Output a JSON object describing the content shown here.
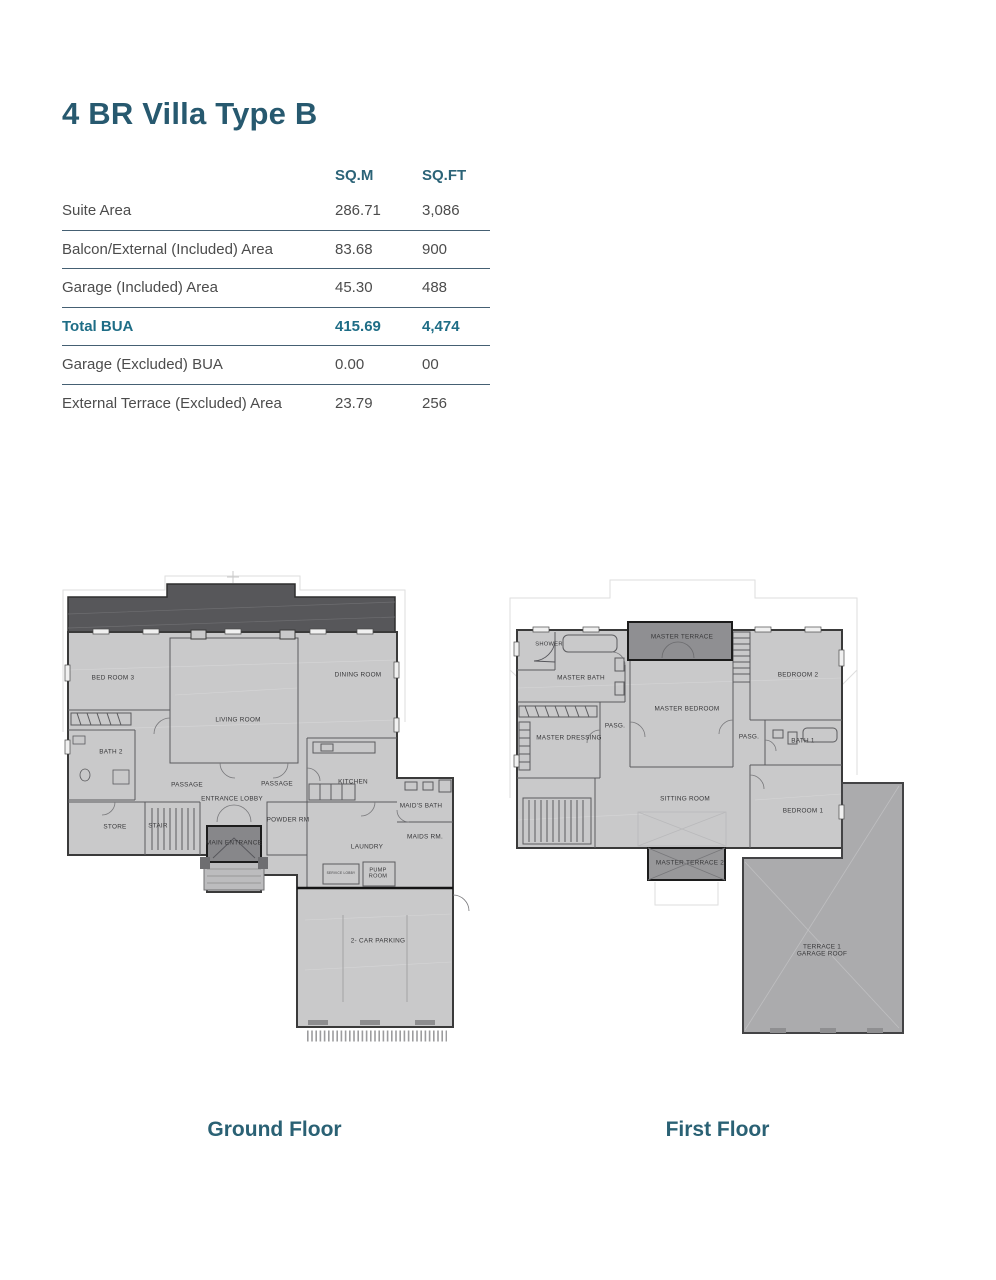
{
  "title": "4 BR Villa Type B",
  "table": {
    "col_headers": [
      "SQ.M",
      "SQ.FT"
    ],
    "rows": [
      {
        "label": "Suite Area",
        "sqm": "286.71",
        "sqft": "3,086",
        "emphasis": false
      },
      {
        "label": "Balcon/External (Included) Area",
        "sqm": "83.68",
        "sqft": "900",
        "emphasis": false
      },
      {
        "label": "Garage (Included) Area",
        "sqm": "45.30",
        "sqft": "488",
        "emphasis": false
      },
      {
        "label": "Total BUA",
        "sqm": "415.69",
        "sqft": "4,474",
        "emphasis": true
      },
      {
        "label": "Garage (Excluded) BUA",
        "sqm": "0.00",
        "sqft": "00",
        "emphasis": false
      },
      {
        "label": "External Terrace (Excluded) Area",
        "sqm": "23.79",
        "sqft": "256",
        "emphasis": false
      }
    ]
  },
  "plans": [
    {
      "caption": "Ground Floor",
      "rooms": [
        {
          "label": "BED ROOM 3",
          "x": 58,
          "y": 108
        },
        {
          "label": "DINING ROOM",
          "x": 303,
          "y": 105
        },
        {
          "label": "LIVING ROOM",
          "x": 183,
          "y": 150
        },
        {
          "label": "BATH 2",
          "x": 56,
          "y": 182
        },
        {
          "label": "PASSAGE",
          "x": 132,
          "y": 215
        },
        {
          "label": "PASSAGE",
          "x": 222,
          "y": 214
        },
        {
          "label": "ENTRANCE LOBBY",
          "x": 177,
          "y": 229
        },
        {
          "label": "KITCHEN",
          "x": 298,
          "y": 212
        },
        {
          "label": "STORE",
          "x": 60,
          "y": 257
        },
        {
          "label": "STAIR",
          "x": 103,
          "y": 256
        },
        {
          "label": "POWDER RM",
          "x": 233,
          "y": 250
        },
        {
          "label": "MAIN ENTRANCE",
          "x": 179,
          "y": 273
        },
        {
          "label": "LAUNDRY",
          "x": 312,
          "y": 277
        },
        {
          "label": "MAID'S BATH",
          "x": 366,
          "y": 236
        },
        {
          "label": "MAIDS RM.",
          "x": 370,
          "y": 267
        },
        {
          "label": "SERVICE LOBBY",
          "x": 286,
          "y": 304,
          "size": 3.2
        },
        {
          "label": "PUMP\nROOM",
          "x": 323,
          "y": 304,
          "size": 5.6
        },
        {
          "label": "2- CAR PARKING",
          "x": 323,
          "y": 371
        }
      ]
    },
    {
      "caption": "First Floor",
      "rooms": [
        {
          "label": "SHOWER",
          "x": 44,
          "y": 75,
          "size": 5.8
        },
        {
          "label": "MASTER TERRACE",
          "x": 177,
          "y": 67
        },
        {
          "label": "BEDROOM 2",
          "x": 293,
          "y": 105
        },
        {
          "label": "MASTER BATH",
          "x": 76,
          "y": 108
        },
        {
          "label": "MASTER BEDROOM",
          "x": 182,
          "y": 139
        },
        {
          "label": "PASG.",
          "x": 110,
          "y": 156
        },
        {
          "label": "MASTER DRESSING",
          "x": 64,
          "y": 168
        },
        {
          "label": "PASG.",
          "x": 244,
          "y": 167
        },
        {
          "label": "BATH 1",
          "x": 298,
          "y": 171
        },
        {
          "label": "SITTING ROOM",
          "x": 180,
          "y": 229
        },
        {
          "label": "BEDROOM 1",
          "x": 298,
          "y": 241
        },
        {
          "label": "MASTER TERRACE 2",
          "x": 185,
          "y": 293
        },
        {
          "label": "TERRACE 1\nGARAGE ROOF",
          "x": 317,
          "y": 381
        }
      ]
    }
  ],
  "colors": {
    "accent": "#2B6377",
    "emphasis": "#1E6D86",
    "body_text": "#4C4C4C",
    "rule_line": "#456073",
    "plan_fill": "#C9C9CA",
    "roof_fill": "#57575A",
    "porch_fill": "#87878A",
    "terrace_fill": "#8F8F92",
    "garage_roof_fill": "#ABABAD"
  }
}
